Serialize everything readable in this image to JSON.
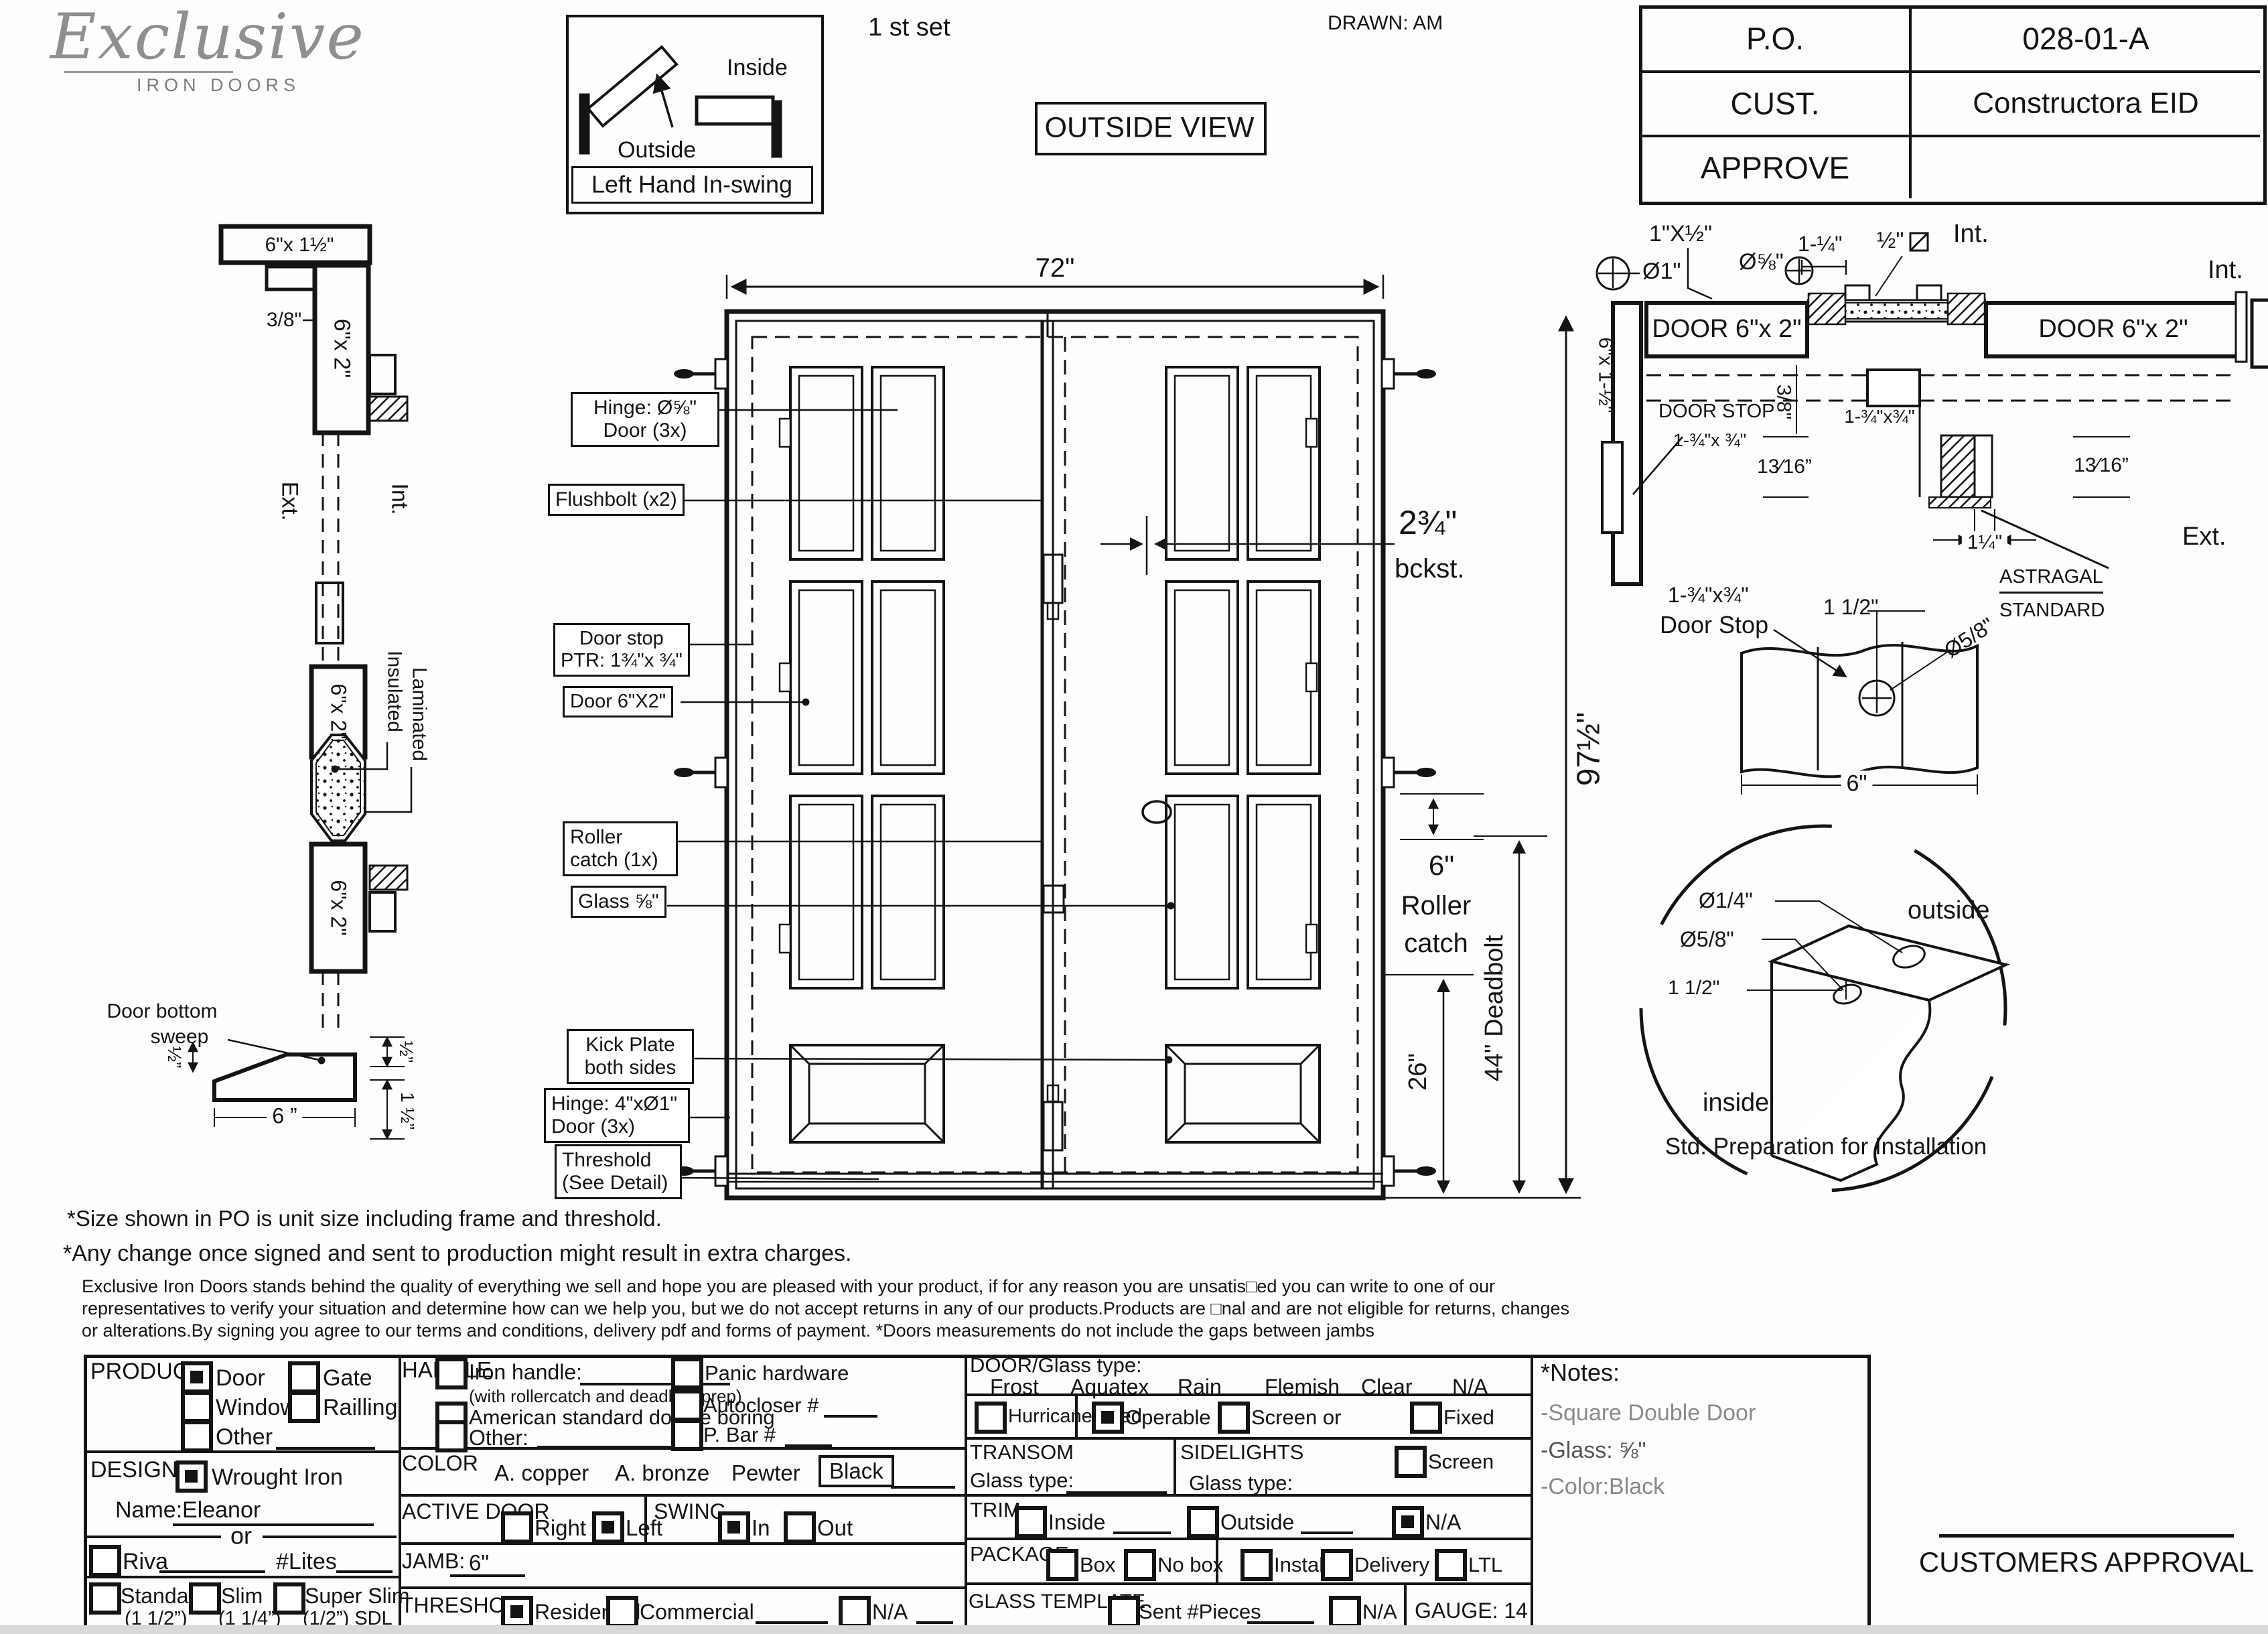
{
  "header": {
    "logo_main": "Exclusive",
    "logo_sub": "IRON DOORS",
    "set_label": "1 st set",
    "drawn_label": "DRAWN: AM",
    "outside_view": "OUTSIDE VIEW"
  },
  "swing": {
    "inside": "Inside",
    "outside": "Outside",
    "caption": "Left Hand In-swing"
  },
  "title_block": {
    "rows": [
      {
        "label": "P.O.",
        "value": "028-01-A"
      },
      {
        "label": "CUST.",
        "value": "Constructora EID"
      },
      {
        "label": "APPROVE",
        "value": ""
      }
    ]
  },
  "left_profile": {
    "head_size": "6\"x 1½\"",
    "gap": "3/8\"",
    "tube": "6\"x 2\"",
    "ext": "Ext.",
    "int": "Int.",
    "insulated": "Insulated",
    "laminated": "Laminated",
    "sweep_line1": "Door bottom",
    "sweep_line2": "sweep",
    "dim_half_left": "½”",
    "dim_6": "6 ”",
    "dim_half_right": "½”",
    "dim_1half_right": "1 ½”"
  },
  "door": {
    "width_dim": "72\"",
    "height_dim": "97½\"",
    "backset_value": "2¾\"",
    "backset_label": "bckst.",
    "roller_dim": "6\"",
    "roller_line1": "Roller",
    "roller_line2": "catch",
    "deadbolt_dim": "44\" Deadbolt",
    "dim_26": "26\"",
    "callouts": {
      "hinge_top_1": "Hinge: Ø⅝\"",
      "hinge_top_2": "Door (3x)",
      "flushbolt": "Flushbolt (x2)",
      "door_stop_1": "Door stop",
      "door_stop_2": "PTR: 1¾\"x ¾\"",
      "door_tube": "Door 6\"X2\"",
      "roller_1": "Roller",
      "roller_2": "catch  (1x)",
      "glass": "Glass ⅝\"",
      "kick_1": "Kick Plate",
      "kick_2": "both sides",
      "hinge_bottom_1": "Hinge: 4\"xØ1\"",
      "hinge_bottom_2": "Door (3x)",
      "threshold_1": "Threshold",
      "threshold_2": "(See Detail)"
    }
  },
  "head_detail": {
    "dim_1x12": "1\"X½\"",
    "dia_58": "Ø⅝\"",
    "dia_1": "Ø1\"",
    "dim_114": "1-¼\"",
    "dim_12": "½\"",
    "int_1": "Int.",
    "int_2": "Int.",
    "door_tube": "DOOR 6\"x 2\"",
    "jamb_side": "6\"x 1-½\"",
    "gap": "3/8\"",
    "door_stop_1": "DOOR STOP",
    "door_stop_2": "1-¾\"x ¾\"",
    "center_size": "1-¾\"x¾\"",
    "dim_1316_left": "13⁄16”",
    "dim_1316_right": "13⁄16”",
    "dim_114b": "1¼\"",
    "astragal_1": "ASTRAGAL",
    "astragal_2": "STANDARD",
    "ext": "Ext."
  },
  "stop_detail": {
    "size": "1-¾\"x¾\"",
    "title": "Door Stop",
    "dim_112": "1 1/2\"",
    "dia_58": "Ø5/8\"",
    "dim_6": "6\""
  },
  "prep_detail": {
    "dia_14": "Ø1/4\"",
    "dia_58": "Ø5/8\"",
    "dim_112": "1 1/2\"",
    "outside": "outside",
    "inside": "inside",
    "caption": "Std. Preparation for Installation"
  },
  "notes": {
    "line1": "*Size shown in PO is unit size including frame and threshold.",
    "line2": "*Any change once signed and sent to production might result in extra charges.",
    "para1": "Exclusive Iron Doors stands behind the quality of everything we sell and hope you are pleased with your product, if for any reason you are unsatis□ed you can write to one of our",
    "para2": "representatives to verify your situation and determine how can we help you, but we do not accept returns in any of our products.Products are □nal and are not eligible for returns, changes",
    "para3": "or alterations.By signing you agree to our terms and conditions, delivery pdf and forms of payment. *Doors measurements do not include the gaps between jambs"
  },
  "form": {
    "product": {
      "label": "PRODUCT:",
      "door": "Door",
      "gate": "Gate",
      "window": "Window",
      "railling": "Railling",
      "other": "Other"
    },
    "design": {
      "label": "DESIGN:",
      "wrought": "Wrought Iron",
      "name_label": "Name:",
      "name_value": "Eleanor",
      "or": "or",
      "riva": "Riva",
      "lites": "#Lites",
      "standard": "Standard",
      "standard_sub": "(1 1/2”)",
      "slim": "Slim",
      "slim_sub": "(1 1/4”)",
      "superslim": "Super Slim",
      "superslim_sub": "(1/2”) SDL"
    },
    "handle": {
      "label": "HANDLE",
      "iron": "Iron handle:",
      "iron_sub": "(with rollercatch and deadbolt prep)",
      "american": "American standard double boring",
      "other": "Other:",
      "panic": "Panic hardware",
      "autocloser": "Autocloser #",
      "pbar": "P. Bar #"
    },
    "color": {
      "label": "COLOR",
      "copper": "A. copper",
      "bronze": "A. bronze",
      "pewter": "Pewter",
      "black": "Black"
    },
    "active_door": {
      "label": "ACTIVE DOOR",
      "right": "Right",
      "left": "Left"
    },
    "swing_opt": {
      "label": "SWING",
      "in": "In",
      "out": "Out"
    },
    "jamb": {
      "label": "JAMB:",
      "value": "6\""
    },
    "threshold": {
      "label": "THRESHOLD",
      "residential": "Residential",
      "commercial": "Commercial",
      "na": "N/A"
    },
    "door_glass": {
      "label": "DOOR/Glass type:",
      "frost": "Frost",
      "aquatex": "Aquatex",
      "rain": "Rain",
      "flemish": "Flemish",
      "clear": "Clear",
      "na": "N/A",
      "hurricane": "Hurricane rated",
      "operable": "Operable",
      "screen_or": "Screen or",
      "fixed": "Fixed"
    },
    "transom": {
      "label": "TRANSOM",
      "glass_type": "Glass type:"
    },
    "sidelights": {
      "label": "SIDELIGHTS",
      "glass_type": "Glass type:",
      "screen": "Screen"
    },
    "trim": {
      "label": "TRIM",
      "inside": "Inside",
      "outside": "Outside",
      "na": "N/A"
    },
    "package": {
      "label": "PACKAGE",
      "box": "Box",
      "nobox": "No box",
      "install": "Install",
      "delivery": "Delivery",
      "ltl": "LTL"
    },
    "glass_template": {
      "label": "GLASS TEMPLATE",
      "sent": "Sent #Pieces",
      "na": "N/A",
      "gauge": "GAUGE: 14"
    },
    "notes": {
      "label": "*Notes:",
      "item1": "-Square Double Door",
      "item2": "-Glass: ⅝\"",
      "item3": "-Color:Black"
    },
    "approval": "CUSTOMERS APPROVAL"
  }
}
